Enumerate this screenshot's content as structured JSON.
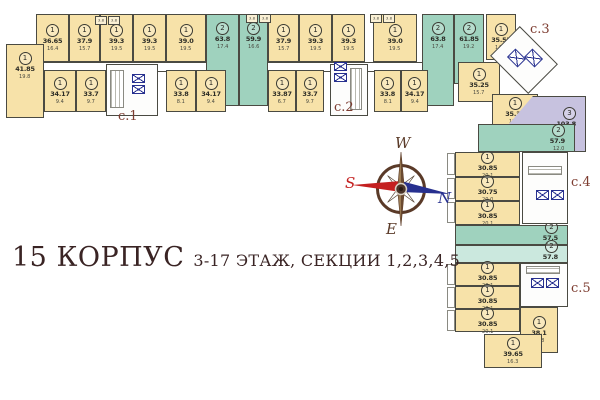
{
  "title": {
    "building": "15 КОРПУС",
    "floors_sections": "3-17 ЭТАЖ, СЕКЦИИ 1,2,3,4,5"
  },
  "compass": {
    "west": "W",
    "south": "S",
    "north": "N",
    "east": "E"
  },
  "palette": {
    "yellow": "#F7E2A9",
    "teal": "#9FD2BE",
    "paleteal": "#CBE8DE",
    "purple": "#C7C2DF",
    "wall": "#4a4a42",
    "seclabel": "#7d3c30",
    "titlec": "#3a2424",
    "red": "#C42020",
    "blue": "#27308F",
    "brown": "#5a3a28"
  },
  "sections": [
    {
      "id": "c.1",
      "x": 118,
      "y": 109
    },
    {
      "id": "c.2",
      "x": 334,
      "y": 100
    },
    {
      "id": "c.3",
      "x": 530,
      "y": 22
    },
    {
      "id": "c.4",
      "x": 571,
      "y": 175
    },
    {
      "id": "c.5",
      "x": 571,
      "y": 281
    }
  ],
  "plan": {
    "corridors": [
      {
        "x": 36,
        "y": 62,
        "w": 452,
        "h": 8
      }
    ],
    "apartments": [
      {
        "sec": 1,
        "rooms": "1",
        "area": "36.65",
        "sub": "16.4",
        "c": "y",
        "x": 36,
        "y": 14,
        "w": 33,
        "h": 48
      },
      {
        "sec": 1,
        "rooms": "1",
        "area": "37.9",
        "sub": "15.7",
        "c": "y",
        "x": 69,
        "y": 14,
        "w": 31,
        "h": 48
      },
      {
        "sec": 1,
        "rooms": "1",
        "area": "39.3",
        "sub": "19.5",
        "c": "y",
        "x": 100,
        "y": 14,
        "w": 33,
        "h": 48
      },
      {
        "sec": 1,
        "rooms": "1",
        "area": "39.3",
        "sub": "19.5",
        "c": "y",
        "x": 133,
        "y": 14,
        "w": 33,
        "h": 48
      },
      {
        "sec": 1,
        "rooms": "1",
        "area": "39.0",
        "sub": "19.5",
        "c": "y",
        "x": 166,
        "y": 14,
        "w": 40,
        "h": 48
      },
      {
        "sec": 1,
        "rooms": "2",
        "area": "63.8",
        "sub": "17.4",
        "c": "t",
        "x": 206,
        "y": 14,
        "w": 33,
        "h": 92,
        "pos": "top"
      },
      {
        "sec": 2,
        "rooms": "2",
        "area": "59.9",
        "sub": "16.6",
        "c": "t",
        "x": 239,
        "y": 14,
        "w": 29,
        "h": 92,
        "pos": "top"
      },
      {
        "sec": 2,
        "rooms": "1",
        "area": "37.9",
        "sub": "15.7",
        "c": "y",
        "x": 268,
        "y": 14,
        "w": 31,
        "h": 48
      },
      {
        "sec": 2,
        "rooms": "1",
        "area": "39.3",
        "sub": "19.5",
        "c": "y",
        "x": 299,
        "y": 14,
        "w": 33,
        "h": 48
      },
      {
        "sec": 2,
        "rooms": "1",
        "area": "39.3",
        "sub": "19.5",
        "c": "y",
        "x": 332,
        "y": 14,
        "w": 33,
        "h": 48
      },
      {
        "sec": 2,
        "rooms": "1",
        "area": "39.0",
        "sub": "19.5",
        "c": "y",
        "x": 373,
        "y": 14,
        "w": 44,
        "h": 48
      },
      {
        "sec": 2,
        "rooms": "2",
        "area": "63.8",
        "sub": "17.4",
        "c": "t",
        "x": 422,
        "y": 14,
        "w": 32,
        "h": 92,
        "pos": "top"
      },
      {
        "sec": 3,
        "rooms": "2",
        "area": "61.85",
        "sub": "19.2",
        "c": "t",
        "x": 454,
        "y": 14,
        "w": 30,
        "h": 70,
        "pos": "top"
      },
      {
        "sec": 3,
        "rooms": "1",
        "area": "35.55",
        "sub": "14.0",
        "c": "y",
        "x": 486,
        "y": 14,
        "w": 30,
        "h": 46
      },
      {
        "sec": 1,
        "rooms": "1",
        "area": "41.85",
        "sub": "19.8",
        "c": "y",
        "x": 6,
        "y": 44,
        "w": 38,
        "h": 74,
        "pos": "top"
      },
      {
        "sec": 1,
        "rooms": "1",
        "area": "34.17",
        "sub": "9.4",
        "c": "y",
        "x": 44,
        "y": 70,
        "w": 32,
        "h": 42
      },
      {
        "sec": 1,
        "rooms": "1",
        "area": "33.7",
        "sub": "9.7",
        "c": "y",
        "x": 76,
        "y": 70,
        "w": 30,
        "h": 42
      },
      {
        "sec": 1,
        "rooms": "1",
        "area": "33.8",
        "sub": "8.1",
        "c": "y",
        "x": 166,
        "y": 70,
        "w": 30,
        "h": 42
      },
      {
        "sec": 1,
        "rooms": "1",
        "area": "34.17",
        "sub": "9.4",
        "c": "y",
        "x": 196,
        "y": 70,
        "w": 30,
        "h": 42
      },
      {
        "sec": 2,
        "rooms": "1",
        "area": "33.87",
        "sub": "6.7",
        "c": "y",
        "x": 268,
        "y": 70,
        "w": 28,
        "h": 42
      },
      {
        "sec": 2,
        "rooms": "1",
        "area": "33.7",
        "sub": "9.7",
        "c": "y",
        "x": 296,
        "y": 70,
        "w": 28,
        "h": 42
      },
      {
        "sec": 2,
        "rooms": "1",
        "area": "33.8",
        "sub": "8.1",
        "c": "y",
        "x": 374,
        "y": 70,
        "w": 27,
        "h": 42
      },
      {
        "sec": 2,
        "rooms": "1",
        "area": "34.17",
        "sub": "9.4",
        "c": "y",
        "x": 401,
        "y": 70,
        "w": 27,
        "h": 42
      },
      {
        "sec": 3,
        "rooms": "1",
        "area": "35.25",
        "sub": "15.7",
        "c": "y",
        "x": 458,
        "y": 62,
        "w": 42,
        "h": 40
      },
      {
        "sec": 3,
        "rooms": "1",
        "area": "35.35",
        "sub": "15.7",
        "c": "y",
        "x": 492,
        "y": 94,
        "w": 46,
        "h": 34
      },
      {
        "sec": 3,
        "rooms": "3",
        "area": "103.8",
        "sub": "23.6",
        "c": "p",
        "x": 508,
        "y": 96,
        "w": 78,
        "h": 56,
        "clip": true,
        "pos": "right",
        "room_areas": [
          "17.7",
          "16.5",
          "13.1",
          "15.2",
          "5.0"
        ]
      },
      {
        "sec": 4,
        "rooms": "2",
        "area": "57.9",
        "sub": "12.0",
        "c": "t",
        "x": 478,
        "y": 124,
        "w": 97,
        "h": 28,
        "pos": "right"
      },
      {
        "sec": 4,
        "rooms": "1",
        "area": "30.85",
        "sub": "20.1",
        "c": "y",
        "x": 455,
        "y": 152,
        "w": 65,
        "h": 25
      },
      {
        "sec": 4,
        "rooms": "1",
        "area": "30.75",
        "sub": "20.0",
        "c": "y",
        "x": 455,
        "y": 177,
        "w": 65,
        "h": 24
      },
      {
        "sec": 4,
        "rooms": "1",
        "area": "30.85",
        "sub": "20.1",
        "c": "y",
        "x": 455,
        "y": 201,
        "w": 65,
        "h": 24
      },
      {
        "sec": 4,
        "rooms": "2",
        "area": "57.5",
        "sub": "11.6",
        "c": "t",
        "x": 455,
        "y": 225,
        "w": 113,
        "h": 20,
        "pos": "right"
      },
      {
        "sec": 5,
        "rooms": "2",
        "area": "57.8",
        "sub": "12.0",
        "c": "pt",
        "x": 455,
        "y": 245,
        "w": 113,
        "h": 18,
        "pos": "right"
      },
      {
        "sec": 5,
        "rooms": "1",
        "area": "30.85",
        "sub": "20.1",
        "c": "y",
        "x": 455,
        "y": 263,
        "w": 65,
        "h": 23
      },
      {
        "sec": 5,
        "rooms": "1",
        "area": "30.85",
        "sub": "20.1",
        "c": "y",
        "x": 455,
        "y": 286,
        "w": 65,
        "h": 23
      },
      {
        "sec": 5,
        "rooms": "1",
        "area": "30.85",
        "sub": "20.1",
        "c": "y",
        "x": 455,
        "y": 309,
        "w": 65,
        "h": 23
      },
      {
        "sec": 5,
        "rooms": "1",
        "area": "38.1",
        "sub": "15.8",
        "c": "y",
        "x": 520,
        "y": 307,
        "w": 38,
        "h": 46
      },
      {
        "sec": 5,
        "rooms": "1",
        "area": "39.65",
        "sub": "16.3",
        "c": "y",
        "x": 484,
        "y": 334,
        "w": 58,
        "h": 34
      }
    ],
    "cores": [
      {
        "x": 106,
        "y": 64,
        "w": 52,
        "h": 52
      },
      {
        "x": 330,
        "y": 64,
        "w": 38,
        "h": 52
      },
      {
        "x": 497,
        "y": 39,
        "w": 54,
        "h": 42,
        "rot": true
      },
      {
        "x": 522,
        "y": 152,
        "w": 46,
        "h": 72
      },
      {
        "x": 520,
        "y": 263,
        "w": 48,
        "h": 44
      }
    ],
    "stairs": [
      {
        "x": 110,
        "y": 70,
        "w": 14,
        "h": 38
      },
      {
        "x": 350,
        "y": 68,
        "w": 12,
        "h": 42
      },
      {
        "x": 528,
        "y": 166,
        "w": 34,
        "h": 9,
        "dir": "h"
      },
      {
        "x": 526,
        "y": 266,
        "w": 34,
        "h": 8,
        "dir": "h"
      }
    ],
    "elevators": [
      {
        "x": 132,
        "y": 74,
        "w": 13,
        "h": 9
      },
      {
        "x": 132,
        "y": 85,
        "w": 13,
        "h": 9
      },
      {
        "x": 334,
        "y": 62,
        "w": 13,
        "h": 9
      },
      {
        "x": 334,
        "y": 73,
        "w": 13,
        "h": 9
      },
      {
        "x": 509,
        "y": 52,
        "w": 15,
        "h": 12,
        "rot": true
      },
      {
        "x": 526,
        "y": 52,
        "w": 15,
        "h": 12,
        "rot": true
      },
      {
        "x": 536,
        "y": 190,
        "w": 13,
        "h": 10
      },
      {
        "x": 551,
        "y": 190,
        "w": 13,
        "h": 10
      },
      {
        "x": 531,
        "y": 278,
        "w": 13,
        "h": 10
      },
      {
        "x": 546,
        "y": 278,
        "w": 13,
        "h": 10
      }
    ],
    "balconies": [
      {
        "x": 95,
        "y": 16,
        "label": "3.8"
      },
      {
        "x": 108,
        "y": 16,
        "label": "3.8"
      },
      {
        "x": 246,
        "y": 14,
        "label": "3.8"
      },
      {
        "x": 259,
        "y": 14,
        "label": "3.8"
      },
      {
        "x": 370,
        "y": 14,
        "label": "3.8"
      },
      {
        "x": 383,
        "y": 14,
        "label": "3.8"
      }
    ],
    "side_balconies": [
      {
        "x": 447,
        "y": 153,
        "w": 8,
        "h": 22
      },
      {
        "x": 447,
        "y": 178,
        "w": 8,
        "h": 21
      },
      {
        "x": 447,
        "y": 202,
        "w": 8,
        "h": 21
      },
      {
        "x": 447,
        "y": 264,
        "w": 8,
        "h": 21
      },
      {
        "x": 447,
        "y": 287,
        "w": 8,
        "h": 21
      },
      {
        "x": 447,
        "y": 310,
        "w": 8,
        "h": 21
      }
    ]
  }
}
